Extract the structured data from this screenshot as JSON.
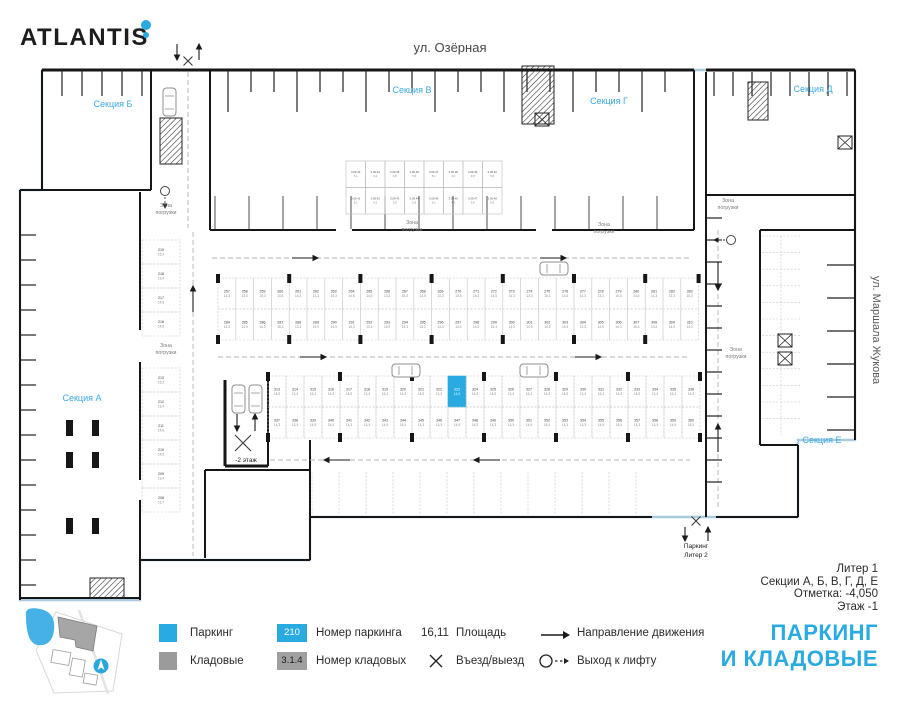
{
  "brand": {
    "name": "ATLANTIS"
  },
  "colors": {
    "accent": "#29abe2",
    "section_label": "#3aa9e2",
    "legend_gray": "#9b9b9b",
    "boundary": "#a9cadf"
  },
  "streets": {
    "top": "ул. Озёрная",
    "right": "ул. Маршала Жукова"
  },
  "sections": {
    "a": "Секция А",
    "b": "Секция Б",
    "v": "Секция В",
    "g": "Секция Г",
    "d": "Секция Д",
    "e": "Секция Е"
  },
  "plan": {
    "zone_label_line1": "Зона",
    "zone_label_line2": "погрузки",
    "ramp_label": "-2 этаж",
    "bottom_entrance_line1": "Паркинг",
    "bottom_entrance_line2": "Литер 2",
    "highlighted_stall": "323",
    "strips": [
      {
        "rows": [
          {
            "numbers": [
              "257",
              "258",
              "259",
              "260",
              "261",
              "262",
              "263",
              "264",
              "265",
              "266",
              "267",
              "268",
              "269",
              "270",
              "271",
              "272",
              "273",
              "274",
              "275",
              "276",
              "277",
              "278",
              "279",
              "280",
              "281",
              "282",
              "283"
            ],
            "areas": [
              "14,3",
              "13,3",
              "15,3",
              "14,5",
              "14,3",
              "13,3",
              "15,3",
              "14,5",
              "14,3",
              "13,3",
              "15,3",
              "14,5",
              "14,3",
              "13,3",
              "15,3",
              "14,5",
              "14,3",
              "13,3",
              "15,3",
              "14,5",
              "14,3",
              "13,3",
              "15,3",
              "14,5",
              "14,3",
              "13,3",
              "15,3"
            ]
          },
          {
            "numbers": [
              "284",
              "285",
              "286",
              "287",
              "288",
              "289",
              "290",
              "291",
              "292",
              "293",
              "294",
              "295",
              "296",
              "297",
              "298",
              "299",
              "300",
              "301",
              "302",
              "303",
              "304",
              "305",
              "306",
              "307",
              "308",
              "309",
              "310"
            ],
            "areas": [
              "13,3",
              "14,9",
              "14,3",
              "15,3",
              "13,3",
              "14,9",
              "14,3",
              "15,3",
              "13,3",
              "14,9",
              "14,3",
              "15,3",
              "13,3",
              "14,9",
              "14,3",
              "15,3",
              "13,3",
              "14,9",
              "14,3",
              "15,3",
              "13,3",
              "14,9",
              "14,3",
              "15,3",
              "13,3",
              "14,9",
              "14,3"
            ]
          }
        ]
      },
      {
        "rows": [
          {
            "numbers": [
              "313",
              "314",
              "315",
              "316",
              "317",
              "318",
              "319",
              "320",
              "321",
              "322",
              "323",
              "324",
              "325",
              "326",
              "327",
              "328",
              "329",
              "330",
              "331",
              "332",
              "333",
              "334",
              "335",
              "336"
            ],
            "areas": [
              "14,5",
              "13,3",
              "15,3",
              "14,3",
              "14,5",
              "13,3",
              "15,3",
              "14,3",
              "14,5",
              "13,3",
              "14,5",
              "14,3",
              "14,5",
              "13,3",
              "15,3",
              "14,3",
              "14,5",
              "13,3",
              "15,3",
              "14,3",
              "14,5",
              "13,3",
              "15,3",
              "14,3"
            ]
          },
          {
            "numbers": [
              "337",
              "338",
              "339",
              "340",
              "341",
              "342",
              "343",
              "344",
              "345",
              "346",
              "347",
              "348",
              "349",
              "350",
              "351",
              "352",
              "353",
              "354",
              "355",
              "356",
              "357",
              "358",
              "359",
              "360"
            ],
            "areas": [
              "14,3",
              "13,3",
              "14,9",
              "15,3",
              "14,3",
              "13,3",
              "14,9",
              "15,3",
              "14,3",
              "13,3",
              "14,9",
              "15,3",
              "14,3",
              "13,3",
              "14,9",
              "15,3",
              "14,3",
              "13,3",
              "14,9",
              "15,3",
              "14,3",
              "13,3",
              "14,9",
              "15,3"
            ]
          }
        ]
      }
    ],
    "left_stalls": {
      "upper": {
        "numbers": [
          "219",
          "218",
          "217",
          "216"
        ],
        "areas": [
          "15,3",
          "13,4",
          "14,6",
          "14,8"
        ]
      },
      "lower": {
        "numbers": [
          "213",
          "212",
          "211",
          "210",
          "209",
          "208"
        ],
        "areas": [
          "15,2",
          "13,4",
          "14,8",
          "14,6",
          "13,4",
          "16,7"
        ]
      }
    },
    "storage_cells": {
      "numbers": [
        "3.09.33",
        "3.09.34",
        "3.09.35",
        "3.09.36",
        "3.09.37",
        "3.09.38",
        "3.09.39",
        "3.09.40",
        "3.09.41",
        "3.09.42",
        "3.09.43",
        "3.09.44",
        "3.09.45",
        "3.09.46",
        "3.09.47",
        "3.09.48"
      ],
      "areas": [
        "5,1",
        "4,2",
        "3,8",
        "5,6",
        "5,1",
        "4,2",
        "3,8",
        "5,6",
        "5,1",
        "4,2",
        "3,8",
        "5,6",
        "5,1",
        "4,2",
        "3,8",
        "5,6"
      ]
    }
  },
  "info": {
    "line1": "Литер 1",
    "line2": "Секции А, Б, В, Г, Д, Е",
    "line3": "Отметка: -4,050",
    "line4": "Этаж -1"
  },
  "legend": {
    "parking": "Паркинг",
    "storage": "Кладовые",
    "parking_number_sample": "210",
    "parking_number_label": "Номер паркинга",
    "storage_number_sample": "3.1.4",
    "storage_number_label": "Номер кладовых",
    "area_sample": "16,11",
    "area_label": "Площадь",
    "entry_label": "Въезд/выезд",
    "direction_label": "Направление движения",
    "lift_label": "Выход к лифту"
  },
  "title": {
    "line1": "ПАРКИНГ",
    "line2": "И КЛАДОВЫЕ"
  }
}
